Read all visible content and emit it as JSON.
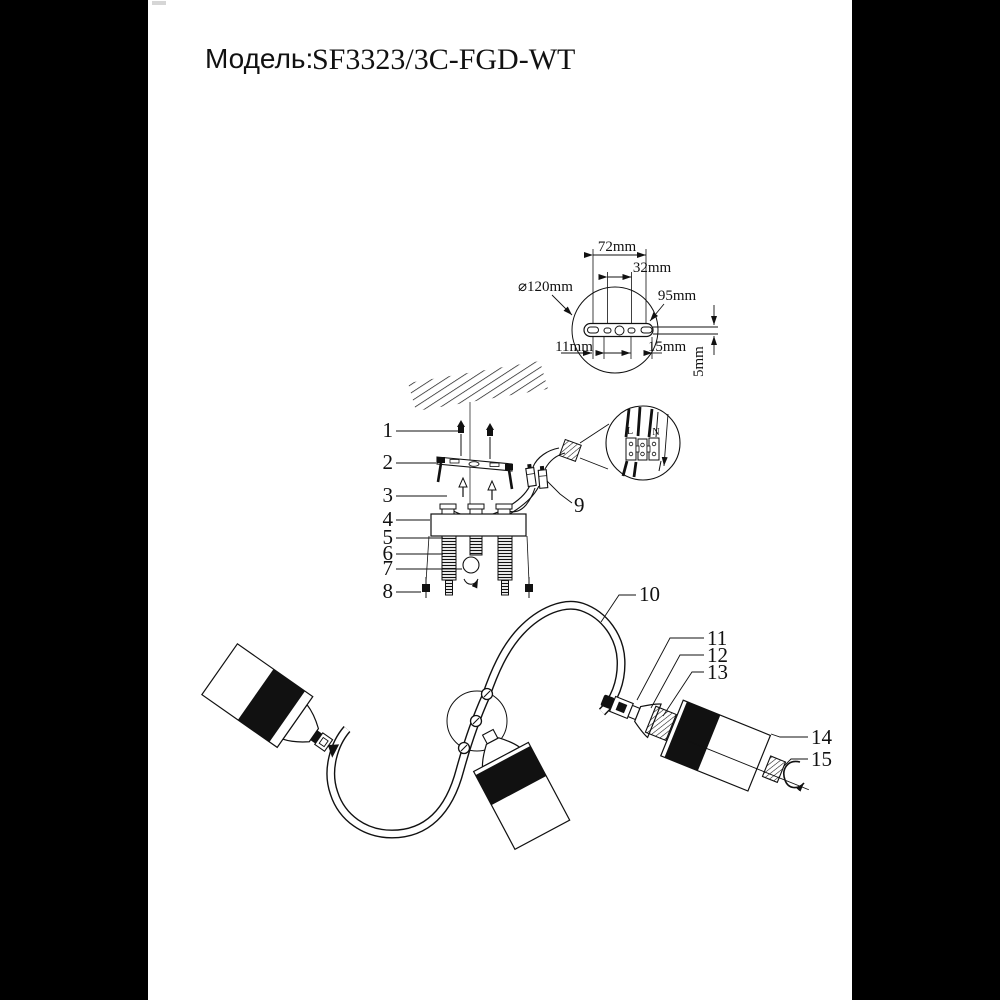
{
  "title": {
    "label": "Модель:",
    "model": "SF3323/3C-FGD-WT"
  },
  "dimensions": {
    "diameter": "⌀120mm",
    "width_72": "72mm",
    "width_32": "32mm",
    "width_95": "95mm",
    "width_11": "11mm",
    "width_15": "15mm",
    "height_5": "5mm"
  },
  "terminal": {
    "live": "L",
    "neutral": "N"
  },
  "parts": {
    "p1": "1",
    "p2": "2",
    "p3": "3",
    "p4": "4",
    "p5": "5",
    "p6": "6",
    "p7": "7",
    "p8": "8",
    "p9": "9",
    "p10": "10",
    "p11": "11",
    "p12": "12",
    "p13": "13",
    "p14": "14",
    "p15": "15"
  },
  "colors": {
    "background": "#000000",
    "paper": "#ffffff",
    "ink": "#111111"
  }
}
